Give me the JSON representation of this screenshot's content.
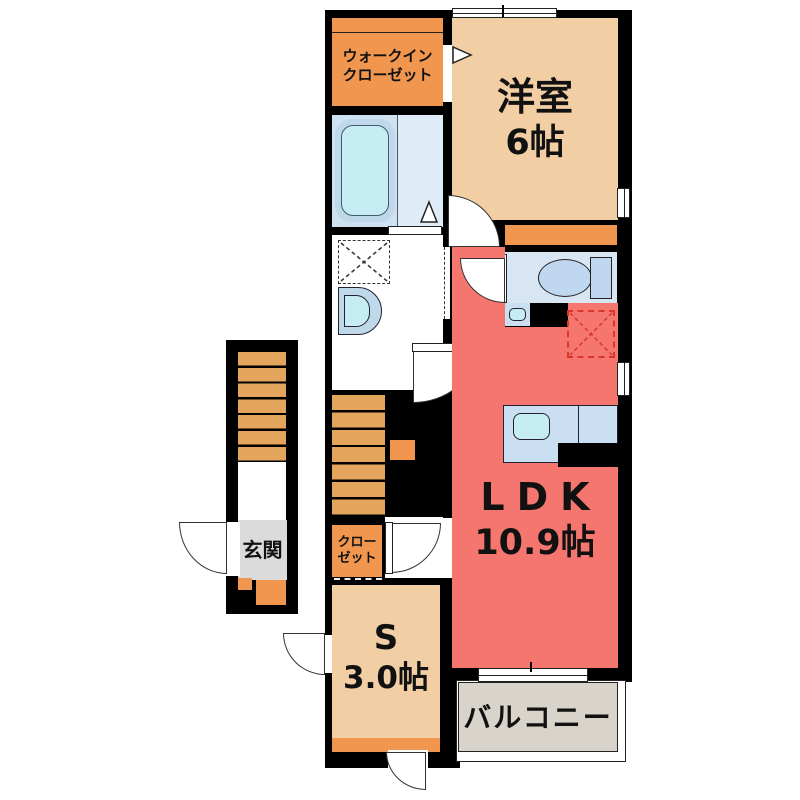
{
  "rooms": {
    "walk_in_closet": {
      "label": "ウォークイン\nクローゼット"
    },
    "western_room": {
      "name": "洋室",
      "size": "6帖"
    },
    "ldk": {
      "name": "LDK",
      "size": "10.9帖"
    },
    "closet": {
      "label": "クロー\nゼット"
    },
    "service_room": {
      "name": "S",
      "size": "3.0帖"
    },
    "balcony": {
      "label": "バルコニー"
    },
    "entrance": {
      "label": "玄関"
    }
  },
  "colors": {
    "wall": "#000000",
    "room_tan": "#F2CEA4",
    "closet_orange": "#F0964F",
    "stairs_orange": "#E3A45C",
    "ldk_red": "#F5766E",
    "water_blue": "#CBDFF2",
    "fixture_cyan": "#C6EDF4",
    "bath_bg": "#DFEBF7",
    "toilet_bg": "#D8E6F4",
    "balcony_gray": "#D9D4CB",
    "entrance_gray": "#DBDBDB",
    "fridge_red": "#D8352B"
  }
}
